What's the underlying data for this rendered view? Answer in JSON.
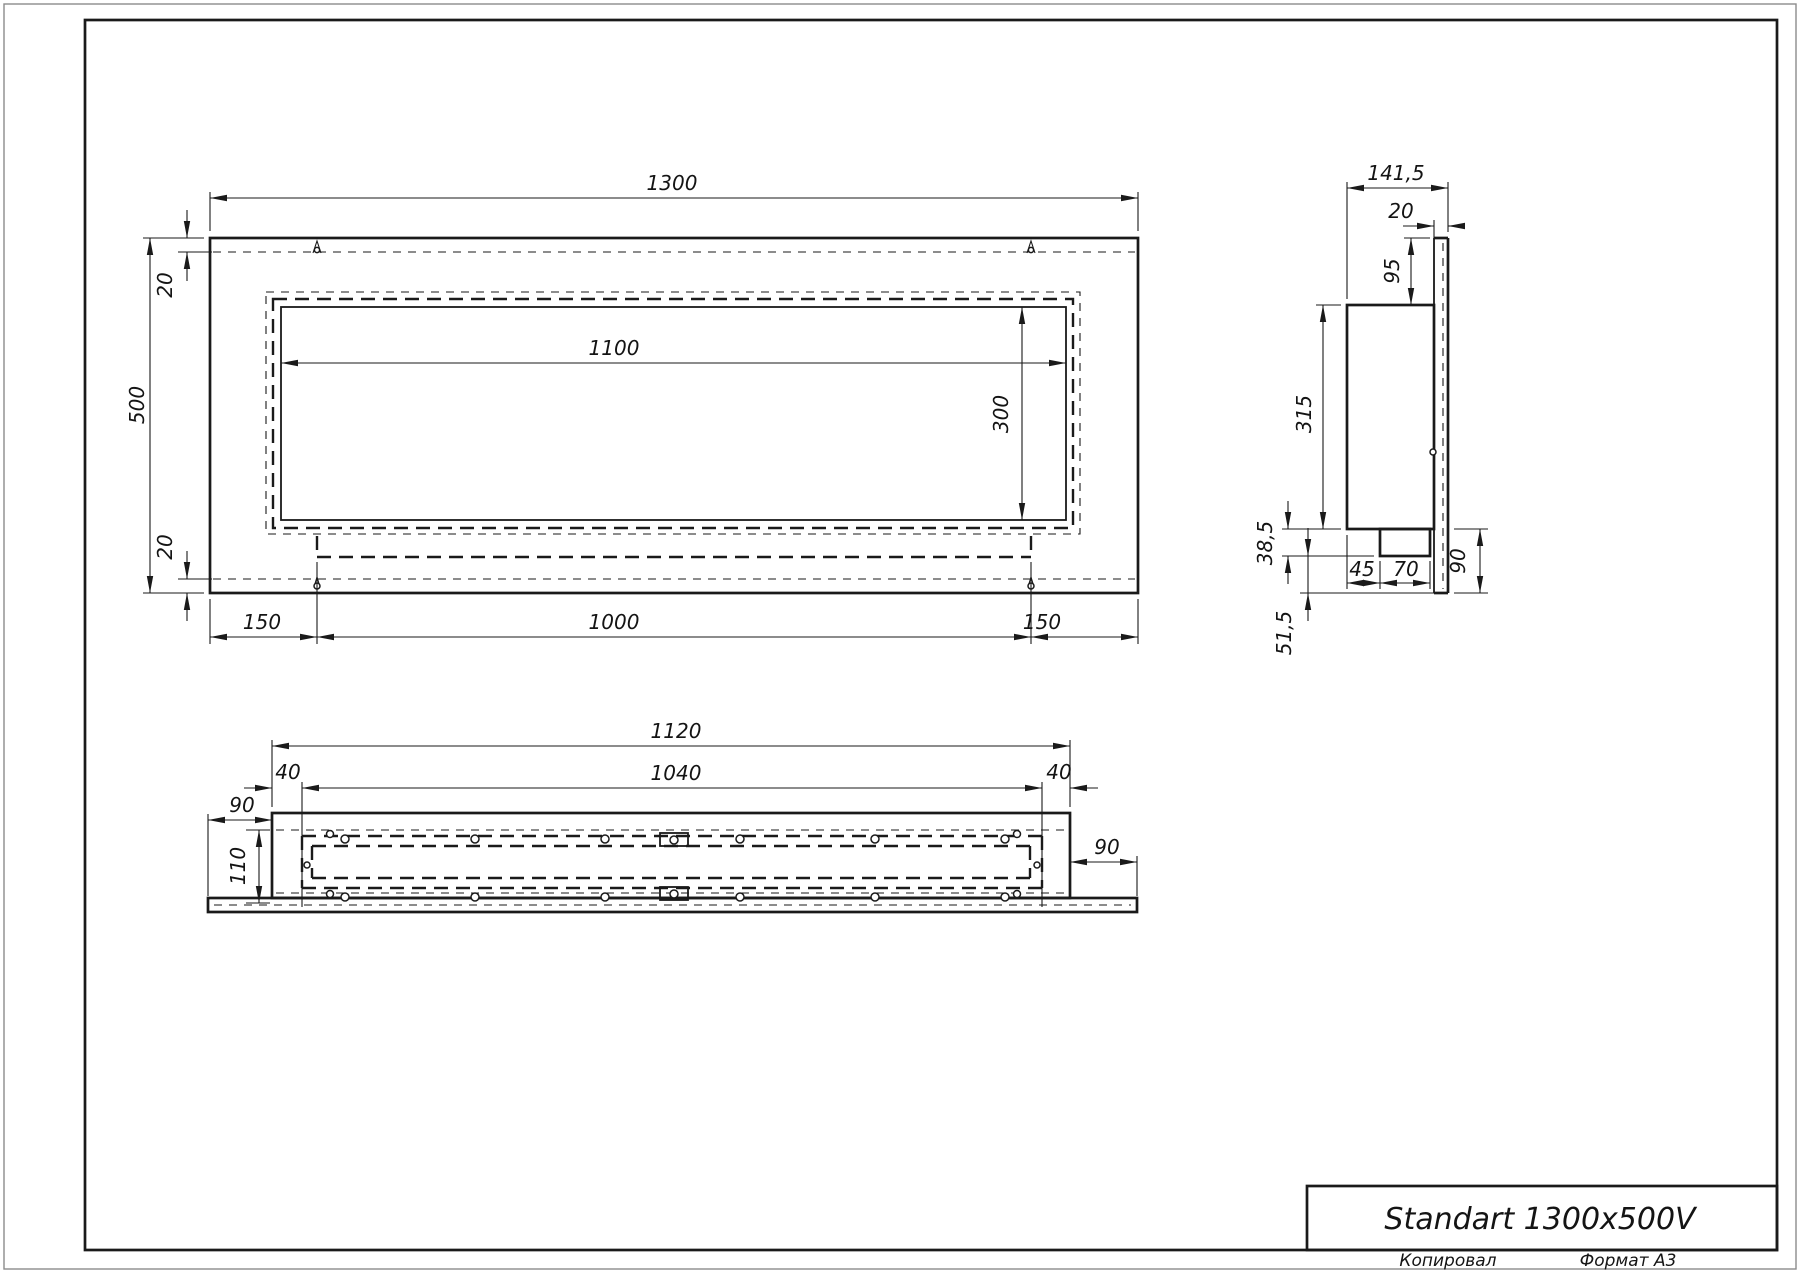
{
  "title_block": {
    "title": "Standart 1300x500V"
  },
  "footer": {
    "copied": "Копировал",
    "format": "Формат A3"
  },
  "front": {
    "width": "1300",
    "height": "500",
    "inset_top": "20",
    "inset_bottom": "20",
    "opening_width": "1100",
    "opening_height": "300",
    "margin_left": "150",
    "tray_width": "1000",
    "margin_right": "150"
  },
  "side": {
    "depth": "141,5",
    "facade_depth": "20",
    "opening_top_offset": "95",
    "body_height": "315",
    "tray_drop": "38,5",
    "bottom_clearance": "51,5",
    "tray_offset": "45",
    "tray_width": "70",
    "lower_height": "90"
  },
  "bottom": {
    "body_width": "1120",
    "inner_width": "1040",
    "inset_left": "40",
    "inset_right": "40",
    "flange_left": "90",
    "flange_right": "90",
    "depth": "110"
  },
  "colors": {
    "line": "#1a1a1a",
    "page_edge": "#8c8c8c",
    "background": "#ffffff"
  }
}
